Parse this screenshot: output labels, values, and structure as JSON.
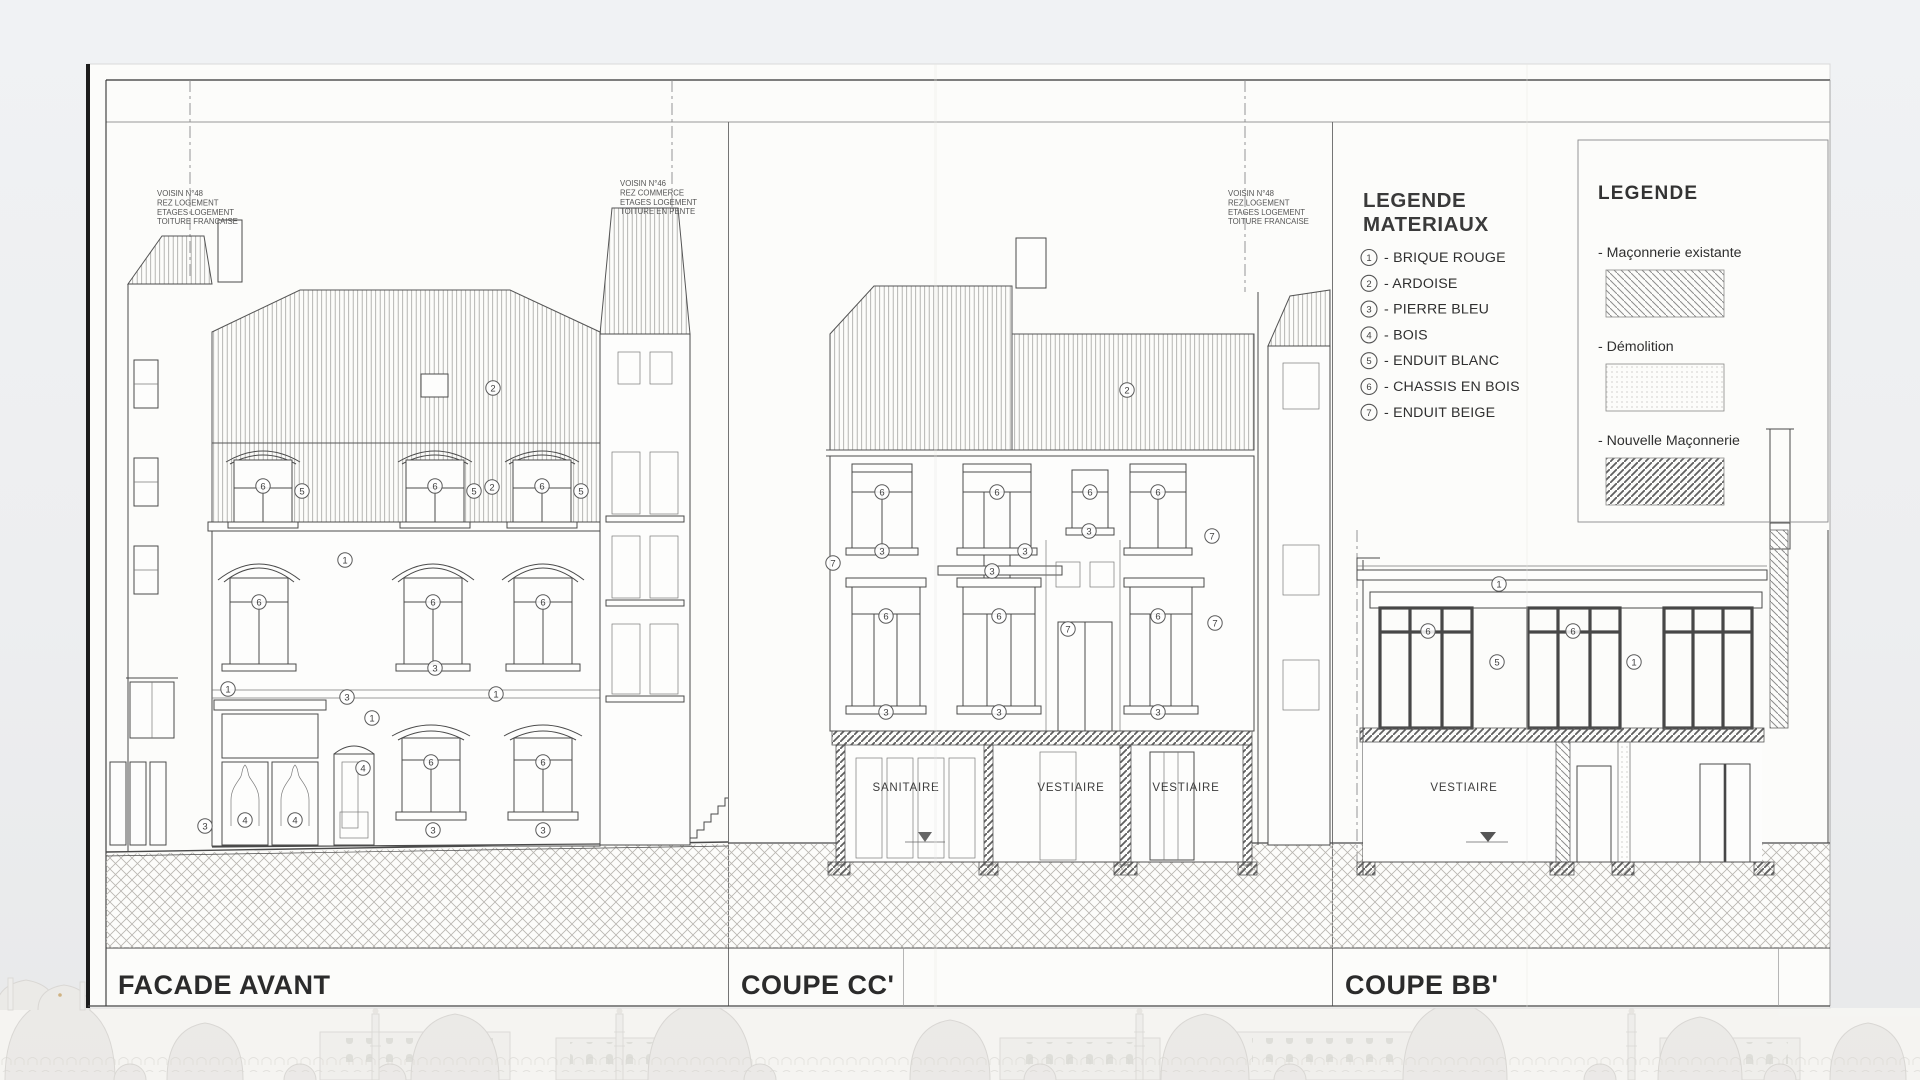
{
  "sheet": {
    "panels": [
      {
        "title": "FACADE AVANT"
      },
      {
        "title": "COUPE CC'"
      },
      {
        "title": "COUPE BB'"
      }
    ]
  },
  "legend_materials": {
    "title_lines": [
      "LEGENDE",
      "MATERIAUX"
    ],
    "items": [
      {
        "num": "1",
        "label": "- BRIQUE ROUGE"
      },
      {
        "num": "2",
        "label": "- ARDOISE"
      },
      {
        "num": "3",
        "label": "- PIERRE BLEU"
      },
      {
        "num": "4",
        "label": "- BOIS"
      },
      {
        "num": "5",
        "label": "- ENDUIT BLANC"
      },
      {
        "num": "6",
        "label": "- CHASSIS EN BOIS"
      },
      {
        "num": "7",
        "label": "- ENDUIT BEIGE"
      }
    ]
  },
  "legend_symbols": {
    "title": "LEGENDE",
    "items": [
      {
        "label": "- Maçonnerie existante",
        "pattern": "existing"
      },
      {
        "label": "- Démolition",
        "pattern": "demolition"
      },
      {
        "label": "- Nouvelle Maçonnerie",
        "pattern": "new"
      }
    ]
  },
  "annotations": [
    {
      "x": 157,
      "y": 196,
      "lines": [
        "VOISIN N°48",
        "REZ LOGEMENT",
        "ETAGES LOGEMENT",
        "TOITURE FRANCAISE"
      ]
    },
    {
      "x": 620,
      "y": 186,
      "lines": [
        "VOISIN N°46",
        "REZ COMMERCE",
        "ETAGES LOGEMENT",
        "TOITURE EN PENTE"
      ]
    },
    {
      "x": 1228,
      "y": 196,
      "lines": [
        "VOISIN N°48",
        "REZ LOGEMENT",
        "ETAGES LOGEMENT",
        "TOITURE FRANCAISE"
      ]
    }
  ],
  "rooms": [
    {
      "label": "SANITAIRE",
      "x": 906,
      "y": 791
    },
    {
      "label": "VESTIAIRE",
      "x": 1071,
      "y": 791
    },
    {
      "label": "VESTIAIRE",
      "x": 1186,
      "y": 791
    },
    {
      "label": "VESTIAIRE",
      "x": 1464,
      "y": 791
    }
  ],
  "material_markers": [
    [
      2,
      493,
      388
    ],
    [
      2,
      492,
      487
    ],
    [
      6,
      263,
      486
    ],
    [
      5,
      302,
      491
    ],
    [
      6,
      435,
      486
    ],
    [
      5,
      474,
      491
    ],
    [
      6,
      542,
      486
    ],
    [
      5,
      581,
      491
    ],
    [
      1,
      345,
      560
    ],
    [
      6,
      259,
      602
    ],
    [
      6,
      433,
      602
    ],
    [
      6,
      543,
      602
    ],
    [
      3,
      435,
      668
    ],
    [
      1,
      228,
      689
    ],
    [
      3,
      347,
      697
    ],
    [
      1,
      372,
      718
    ],
    [
      1,
      496,
      694
    ],
    [
      6,
      431,
      762
    ],
    [
      6,
      543,
      762
    ],
    [
      3,
      433,
      830
    ],
    [
      3,
      543,
      830
    ],
    [
      3,
      205,
      826
    ],
    [
      4,
      245,
      820
    ],
    [
      4,
      295,
      820
    ],
    [
      4,
      363,
      768
    ],
    [
      2,
      1127,
      390
    ],
    [
      7,
      833,
      563
    ],
    [
      7,
      1212,
      536
    ],
    [
      7,
      1068,
      629
    ],
    [
      7,
      1215,
      623
    ],
    [
      6,
      882,
      492
    ],
    [
      6,
      997,
      492
    ],
    [
      6,
      1090,
      492
    ],
    [
      6,
      1158,
      492
    ],
    [
      3,
      882,
      551
    ],
    [
      3,
      1025,
      551
    ],
    [
      3,
      1089,
      531
    ],
    [
      3,
      992,
      571
    ],
    [
      6,
      886,
      616
    ],
    [
      6,
      999,
      616
    ],
    [
      6,
      1158,
      616
    ],
    [
      3,
      886,
      712
    ],
    [
      3,
      999,
      712
    ],
    [
      3,
      1158,
      712
    ],
    [
      1,
      1499,
      584
    ],
    [
      6,
      1428,
      631
    ],
    [
      6,
      1573,
      631
    ],
    [
      5,
      1497,
      662
    ],
    [
      1,
      1634,
      662
    ]
  ],
  "colors": {
    "ink": "#4a4a4a",
    "sheet": "#fcfcfa",
    "background": "#edeff1",
    "gold_finial": "#c9a66a"
  }
}
